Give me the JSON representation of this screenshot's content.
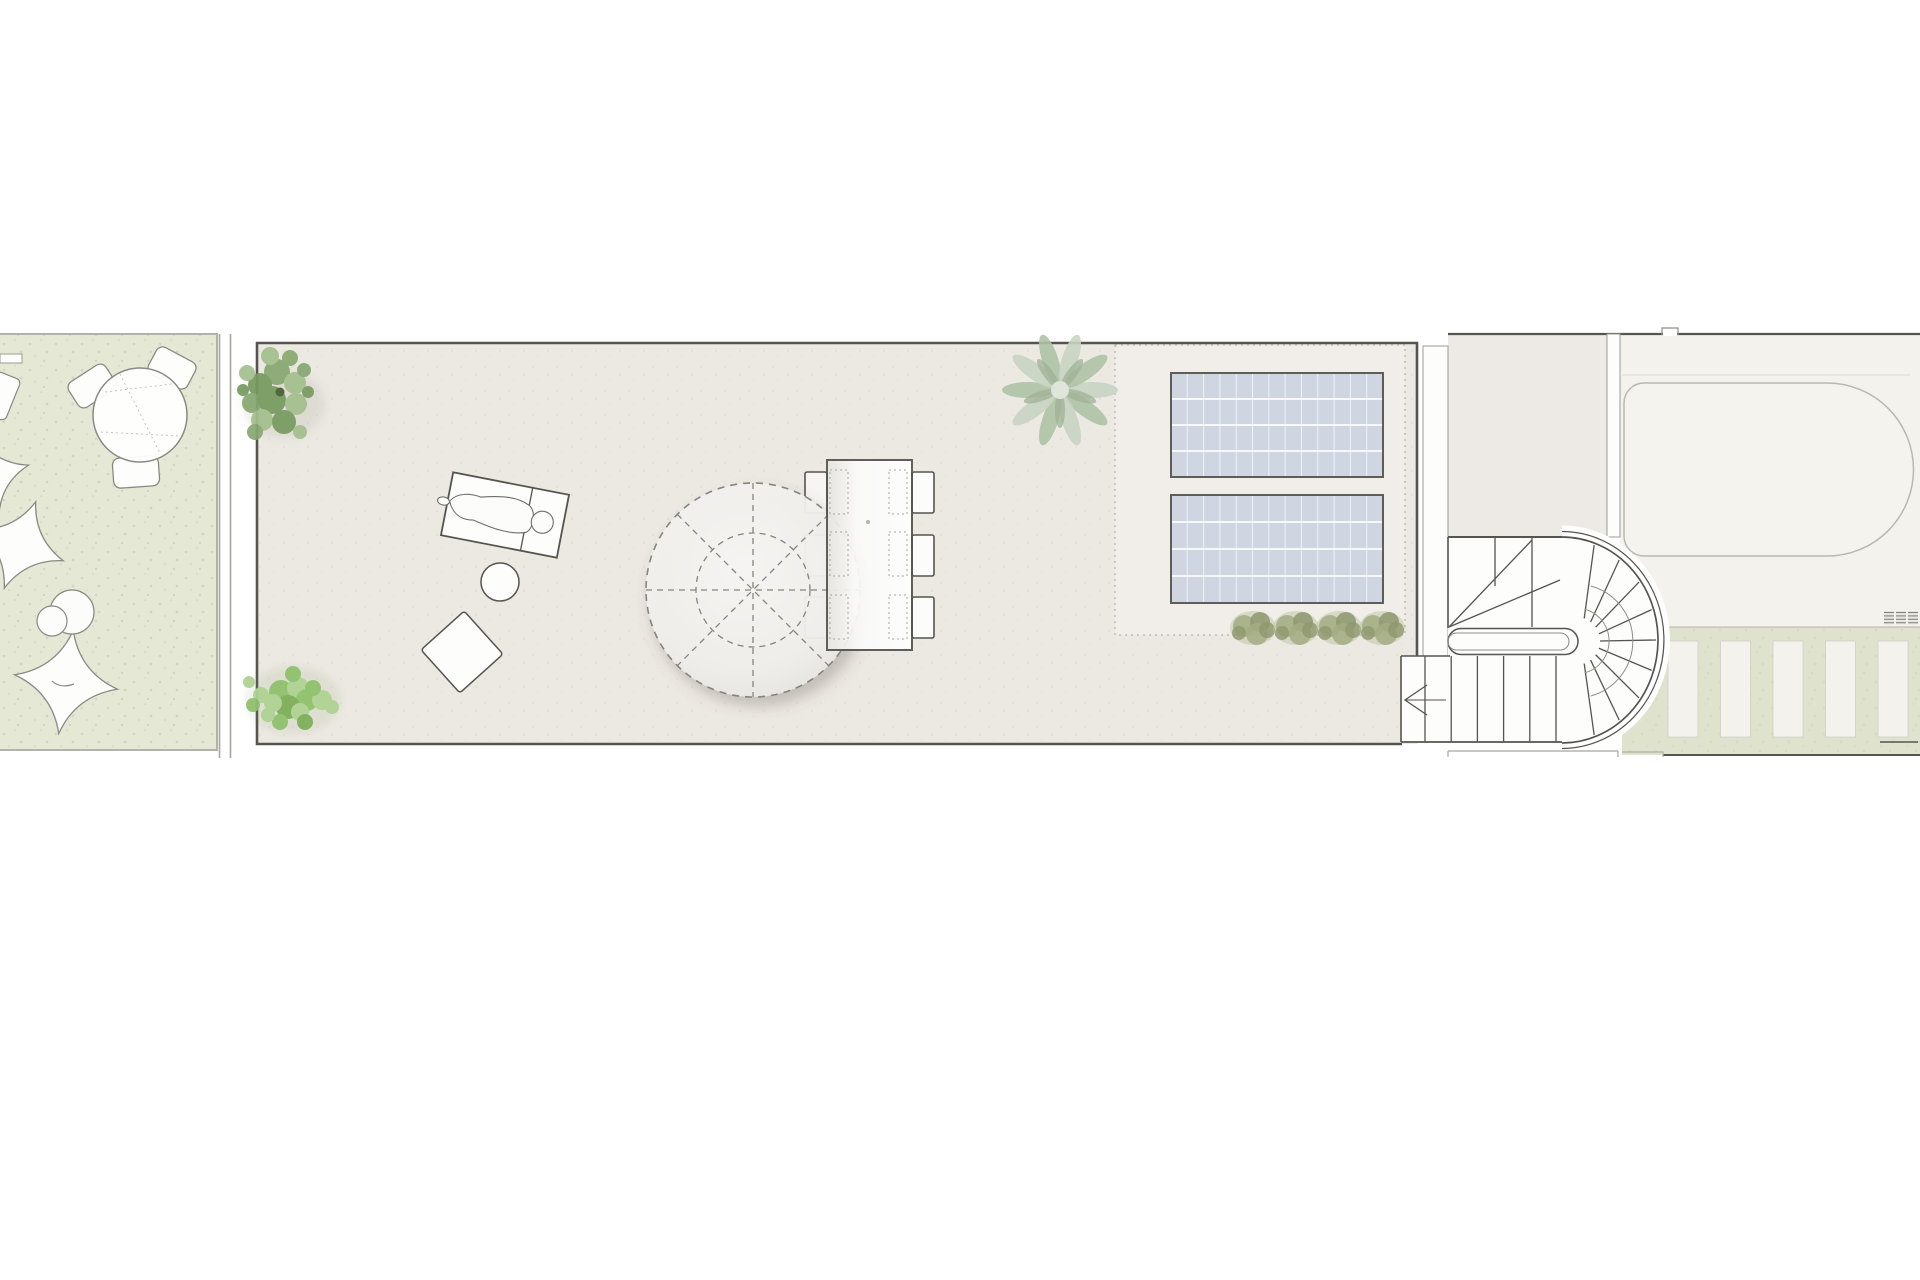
{
  "meta": {
    "title": "Roof terrace floor plan",
    "document_type": "architectural-site-plan",
    "visible_text": "none"
  },
  "colors": {
    "bg": "#ffffff",
    "garden_green": "#e5e8d5",
    "garden_speckle": "#cdd2b8",
    "garden_border": "#b2b2aa",
    "terrace_beige": "#ece8e2",
    "terrace_speckle": "#e0dcd3",
    "inset_light": "#f1eee9",
    "line_dark": "#55544e",
    "line_mid": "#8f8f88",
    "line_light": "#b5b3ab",
    "white_fill": "#fdfdfc",
    "wall_stroke": "#9b9b93",
    "panel_blue": "#cfd6e2",
    "panel_border": "#5e5e59",
    "panel_grid": "#ffffff",
    "tree_green_1": "#87a871",
    "tree_green_2": "#769a5e",
    "tree_green_3": "#a3bf8d",
    "tree_dark": "#4f673d",
    "bush_green_1": "#8fc06c",
    "bush_green_2": "#aed392",
    "bush_green_3": "#7db05a",
    "agave_light": "#c8d4c3",
    "agave_mid": "#aec2a6",
    "agave_dark": "#9fb295",
    "shrub_olive_1": "#a3ab83",
    "shrub_olive_2": "#8e976e",
    "shrub_olive_3": "#b8bf9b",
    "pool_area": "#f4f2ed",
    "pool_line": "#b9b7b1",
    "pergola_green": "#dfe2cc",
    "slat_white": "#f3f2ed",
    "room_beige": "#edeae5",
    "shadow": "rgba(95,90,82,0.30)"
  },
  "garden": {
    "chair_count": 3,
    "round_table_count": 1,
    "bean_bag_count": 2,
    "pouf_count": 2
  },
  "terrace": {
    "sun_lounger_count": 1,
    "side_ball_count": 1,
    "floor_cushion_count": 1,
    "parasol_spoke_count": 8,
    "tree_count": 1,
    "bush_count": 1,
    "agave_count": 1,
    "shrub_row_count": 4,
    "solar_panels": {
      "count": 2,
      "grid_columns": 13,
      "grid_rows": 4
    }
  },
  "dining": {
    "table_count": 1,
    "chair_rows": 3,
    "chair_columns": 2,
    "placemat_rows": 3
  },
  "stair": {
    "type": "switchback-with-winders",
    "winder_line_count": 9,
    "lower_tread_line_count": 6,
    "upper_vertical_tread_lines": 2,
    "direction_arrow": "left"
  },
  "pool_area": {
    "pool_count": 1,
    "vent_block_count": 3,
    "vent_stripe_count": 4
  },
  "pergola": {
    "slat_count": 5
  }
}
